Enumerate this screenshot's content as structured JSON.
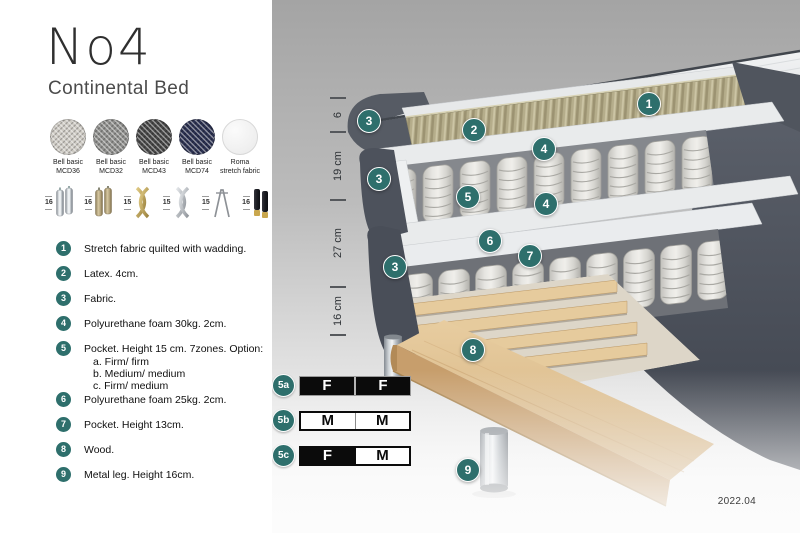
{
  "header": {
    "title": "No4",
    "subtitle": "Continental Bed"
  },
  "fabrics": [
    {
      "name": "Bell basic",
      "code": "MCD36"
    },
    {
      "name": "Bell basic",
      "code": "MCD32"
    },
    {
      "name": "Bell basic",
      "code": "MCD43"
    },
    {
      "name": "Bell basic",
      "code": "MCD74"
    },
    {
      "name": "Roma",
      "code": "stretch fabric"
    }
  ],
  "leg_options": [
    {
      "height": "16",
      "type": "cylinder-chrome"
    },
    {
      "height": "16",
      "type": "cylinder-bronze"
    },
    {
      "height": "15",
      "type": "twist-gold"
    },
    {
      "height": "15",
      "type": "twist-silver"
    },
    {
      "height": "15",
      "type": "hairpin"
    },
    {
      "height": "16",
      "type": "cylinder-black-gold"
    }
  ],
  "features": [
    {
      "num": "1",
      "text": "Stretch fabric quilted with wadding."
    },
    {
      "num": "2",
      "text": "Latex. 4cm."
    },
    {
      "num": "3",
      "text": "Fabric."
    },
    {
      "num": "4",
      "text": "Polyurethane foam 30kg. 2cm."
    },
    {
      "num": "5",
      "text": "Pocket. Height 15 cm. 7zones. Option:",
      "options": [
        "a. Firm/ firm",
        "b. Medium/ medium",
        "c. Firm/ medium"
      ]
    },
    {
      "num": "6",
      "text": "Polyurethane foam 25kg. 2cm."
    },
    {
      "num": "7",
      "text": "Pocket. Height 13cm."
    },
    {
      "num": "8",
      "text": "Wood."
    },
    {
      "num": "9",
      "text": "Metal leg. Height 16cm."
    }
  ],
  "diagram": {
    "dimensions": [
      {
        "label": "6"
      },
      {
        "label": "19 cm"
      },
      {
        "label": "27 cm"
      },
      {
        "label": "16 cm"
      }
    ],
    "badges": [
      {
        "label": "1"
      },
      {
        "label": "2"
      },
      {
        "label": "3"
      },
      {
        "label": "3"
      },
      {
        "label": "3"
      },
      {
        "label": "4"
      },
      {
        "label": "4"
      },
      {
        "label": "5"
      },
      {
        "label": "6"
      },
      {
        "label": "7"
      },
      {
        "label": "8"
      },
      {
        "label": "9"
      }
    ],
    "firmness": [
      {
        "badge": "5a",
        "cells": [
          {
            "letter": "F"
          },
          {
            "letter": "F"
          }
        ]
      },
      {
        "badge": "5b",
        "cells": [
          {
            "letter": "M"
          },
          {
            "letter": "M"
          }
        ]
      },
      {
        "badge": "5c",
        "cells": [
          {
            "letter": "F"
          },
          {
            "letter": "M"
          }
        ]
      }
    ],
    "version": "2022.04"
  },
  "colors": {
    "badge_teal": "#2e6f6c",
    "firmness_black": "#0b0b0b"
  }
}
